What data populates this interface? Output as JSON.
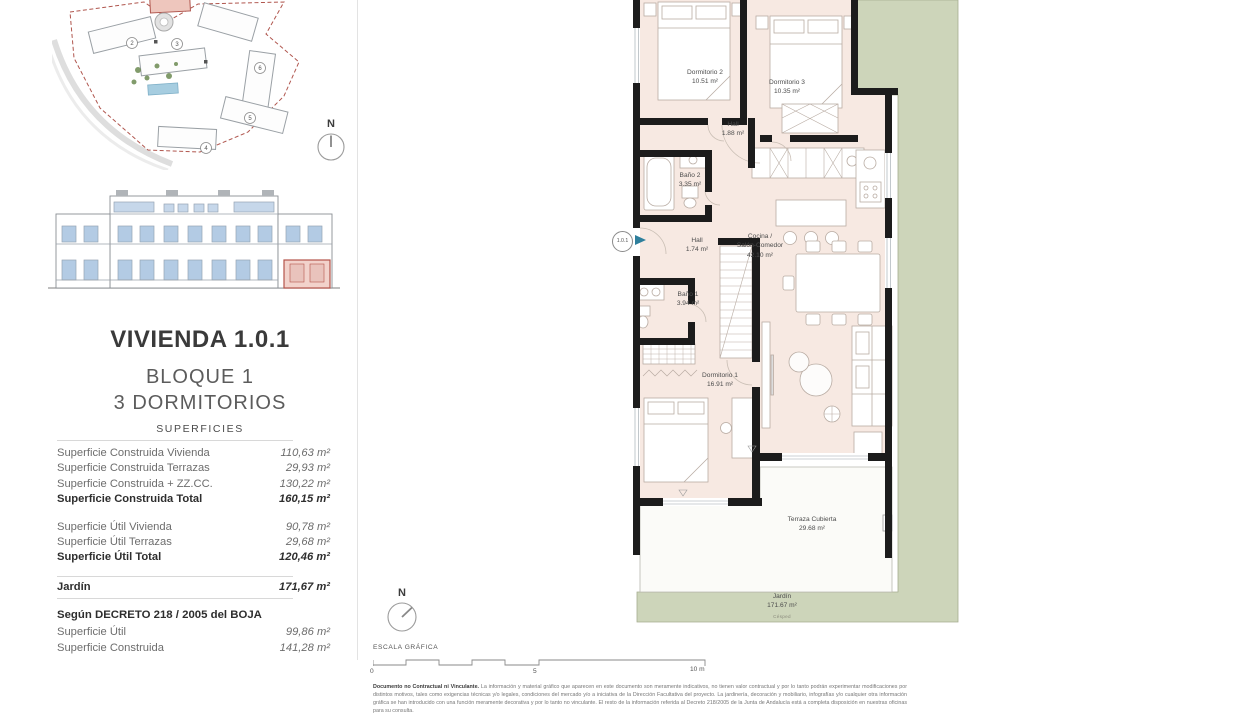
{
  "colors": {
    "wall": "#1c1c1c",
    "floor_pink": "#f7e9e2",
    "garden_green": "#cdd5ba",
    "terrace_white": "#fbfbf8",
    "accent_teal": "#2e7f9c",
    "highlight_red": "#b5544a",
    "elevation_blue": "#bcd0e6"
  },
  "left_panel": {
    "title": "VIVIENDA 1.0.1",
    "block": "BLOQUE 1",
    "bedrooms": "3 DORMITORIOS",
    "surfaces_heading": "SUPERFICIES",
    "built_rows": [
      {
        "label": "Superficie Construida Vivienda",
        "value": "110,63 m²"
      },
      {
        "label": "Superficie Construida Terrazas",
        "value": "29,93 m²"
      },
      {
        "label": "Superficie Construida + ZZ.CC.",
        "value": "130,22 m²"
      },
      {
        "label": "Superficie Construida Total",
        "value": "160,15 m²"
      }
    ],
    "useful_rows": [
      {
        "label": "Superficie Útil Vivienda",
        "value": "90,78 m²"
      },
      {
        "label": "Superficie Útil Terrazas",
        "value": "29,68 m²"
      },
      {
        "label": "Superficie Útil Total",
        "value": "120,46 m²"
      }
    ],
    "garden_row": {
      "label": "Jardín",
      "value": "171,67 m²"
    },
    "decree_heading": "Según DECRETO 218 / 2005 del BOJA",
    "decree_rows": [
      {
        "label": "Superficie Útil",
        "value": "99,86 m²"
      },
      {
        "label": "Superficie Construida",
        "value": "141,28 m²"
      }
    ]
  },
  "site": {
    "numbers": [
      "2",
      "3",
      "4",
      "5",
      "6"
    ]
  },
  "north": {
    "label": "N"
  },
  "plan": {
    "unit_marker": "1.0.1",
    "rooms": [
      {
        "name": "Dormitorio 2",
        "area": "10.51 m²"
      },
      {
        "name": "Dormitorio 3",
        "area": "10.35 m²"
      },
      {
        "name": "Hall",
        "area": "1.88 m²"
      },
      {
        "name": "Baño 2",
        "area": "3.35 m²"
      },
      {
        "name": "Hall",
        "area": "1.74 m²"
      },
      {
        "name": "Cocina /",
        "name2": "Salón-Comedor",
        "area": "42.10 m²"
      },
      {
        "name": "Baño 1",
        "area": "3.94 m²"
      },
      {
        "name": "Dormitorio 1",
        "area": "16.91 m²"
      },
      {
        "name": "Terraza Cubierta",
        "area": "29.68 m²"
      },
      {
        "name": "Jardín",
        "area": "171.67 m²",
        "note": "Césped"
      }
    ]
  },
  "scale_bar": {
    "heading": "ESCALA GRÁFICA",
    "tick0": "0",
    "tick5": "5",
    "tick10": "10 m"
  },
  "disclaimer": {
    "lead": "Documento no Contractual ni Vinculante.",
    "body": " La información y material gráfico que aparecen en este documento son meramente indicativos, no tienen valor contractual y por lo tanto podrán experimentar modificaciones por distintos motivos, tales como exigencias técnicas y/o legales, condiciones del mercado y/o a iniciativa de la Dirección Facultativa del proyecto. La jardinería, decoración y mobiliario, infografías y/o cualquier otra información gráfica se han introducido con una función meramente decorativa y por lo tanto no vinculante. El resto de la información referida al Decreto 218/2005 de la Junta de Andalucía está a completa disposición en nuestras oficinas para su consulta."
  }
}
